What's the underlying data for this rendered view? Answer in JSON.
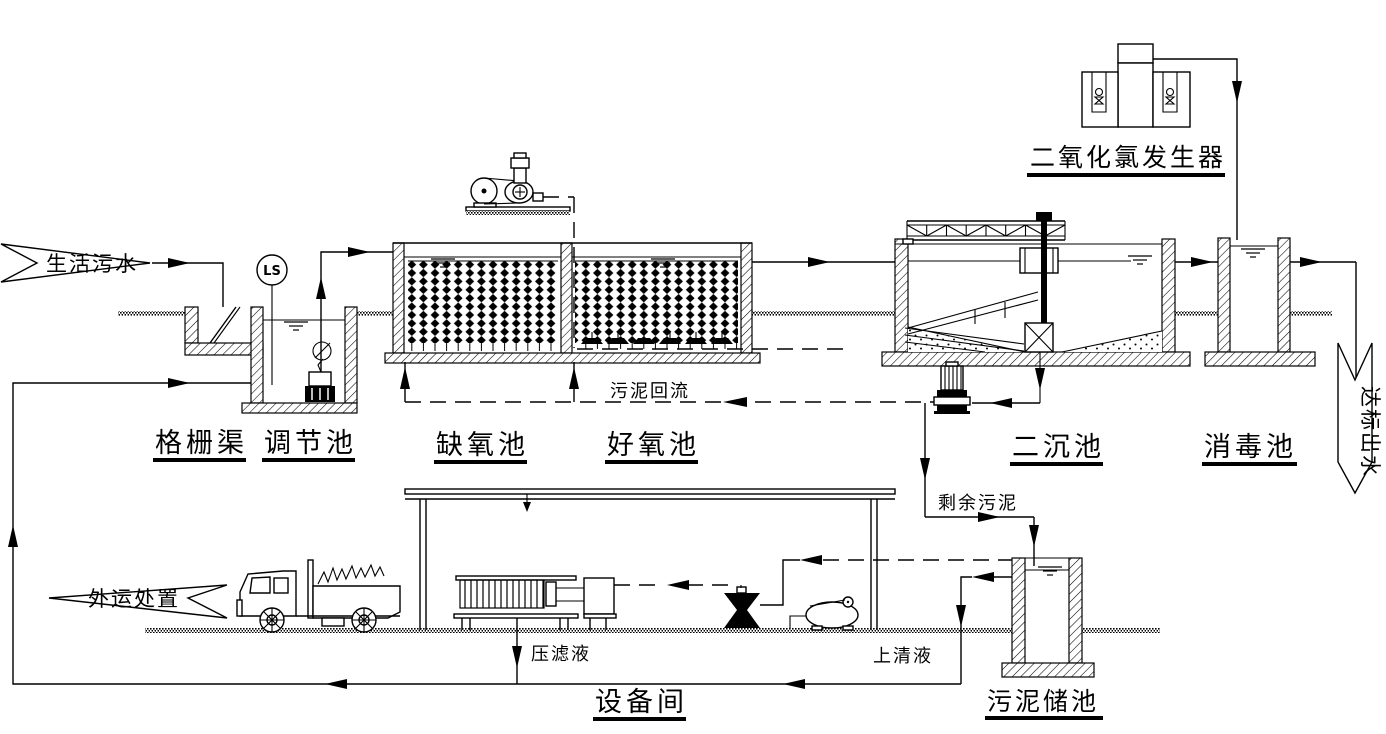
{
  "diagram": {
    "type": "wastewater-treatment-process-flow",
    "banners": {
      "influent": "生活污水",
      "effluent": "达标出水",
      "disposal": "外运处置"
    },
    "units": {
      "grid_channel": "格栅渠",
      "regulating_tank": "调节池",
      "anoxic_tank": "缺氧池",
      "aerobic_tank": "好氧池",
      "secondary_clarifier": "二沉池",
      "disinfection_tank": "消毒池",
      "clo2_generator": "二氧化氯发生器",
      "equipment_room": "设备间",
      "sludge_storage_tank": "污泥储池"
    },
    "streams": {
      "sludge_return": "污泥回流",
      "excess_sludge": "剩余污泥",
      "filtrate": "压滤液",
      "supernatant": "上清液"
    },
    "instruments": {
      "level_switch": "LS"
    },
    "colors": {
      "line": "#000000",
      "background": "#ffffff"
    }
  }
}
